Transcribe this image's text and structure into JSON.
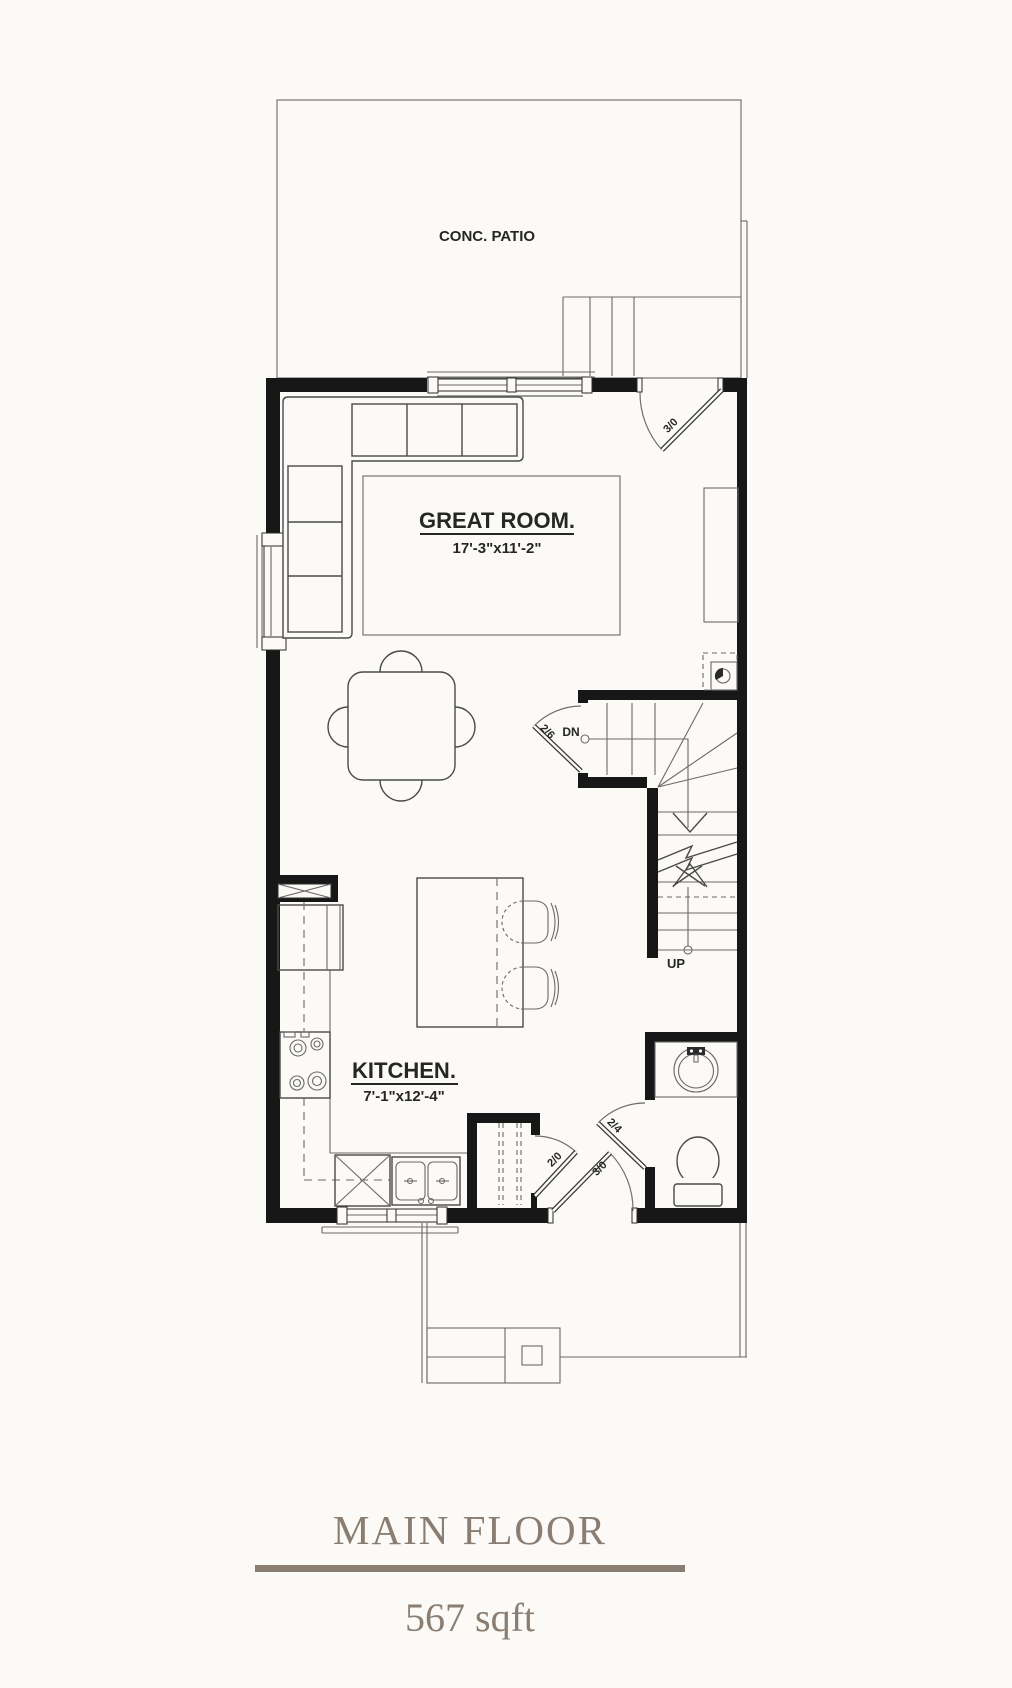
{
  "page": {
    "bg": "#fcfaf6"
  },
  "title_block": {
    "title": "MAIN FLOOR",
    "area": "567 sqft",
    "accent": "#8a7d71"
  },
  "plan": {
    "colors": {
      "wall": "#171717",
      "line": "#4a4a4a"
    },
    "labels": {
      "patio": "CONC. PATIO",
      "great_room_name": "GREAT ROOM.",
      "great_room_dims": "17'-3\"x11'-2\"",
      "kitchen_name": "KITCHEN.",
      "kitchen_dims": "7'-1\"x12'-4\"",
      "stair_down": "DN",
      "stair_up": "UP"
    },
    "doors": {
      "back": "3/0",
      "stair": "2/6",
      "closet": "2/0",
      "entry": "3/0",
      "bath": "2/4"
    }
  }
}
